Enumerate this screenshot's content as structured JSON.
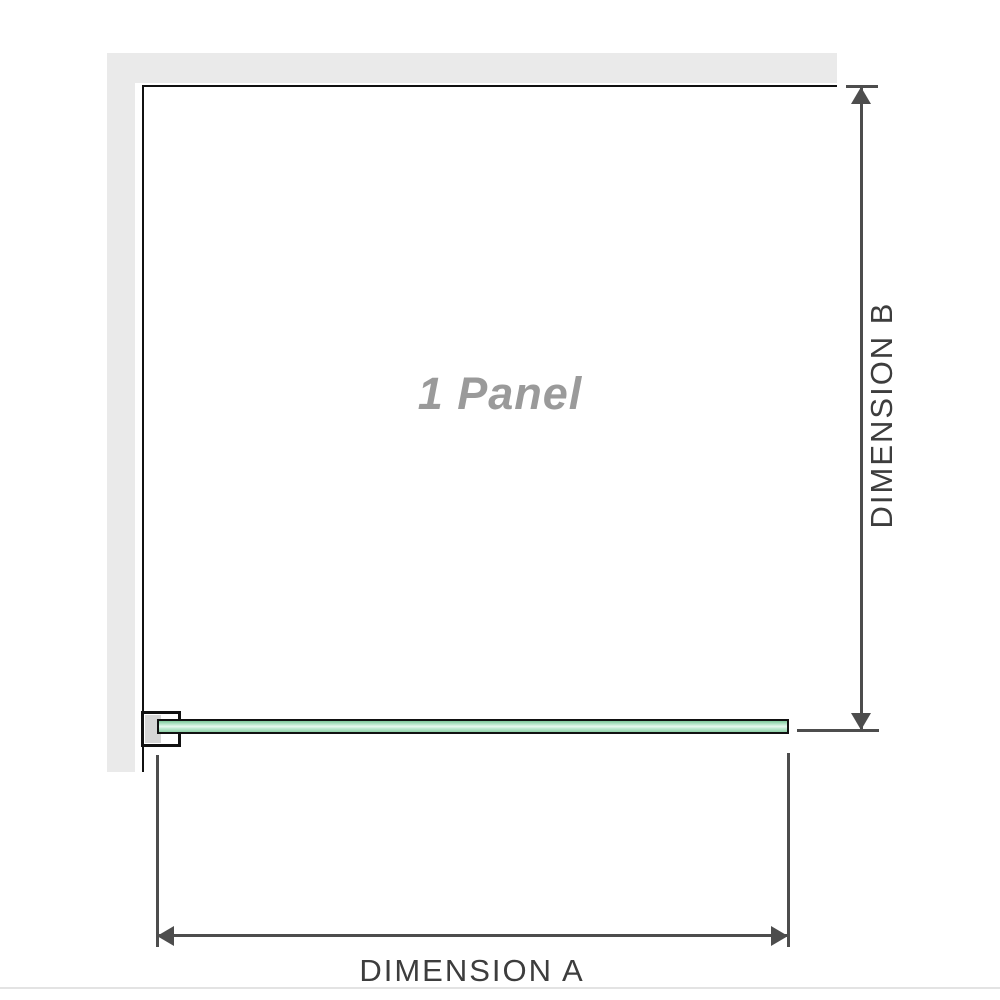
{
  "diagram": {
    "panel_label": "1 Panel",
    "dimension_a": {
      "label": "DIMENSION A"
    },
    "dimension_b": {
      "label": "DIMENSION B"
    }
  },
  "icons": {
    "arrow_up": "triangle-up",
    "arrow_down": "triangle-down",
    "arrow_left": "triangle-left",
    "arrow_right": "triangle-right"
  },
  "colors": {
    "background": "#ffffff",
    "wall_gray": "#eaeaea",
    "frame_black": "#111111",
    "glass_green": "#8fd2a8",
    "glass_highlight": "#e9f9f0",
    "bracket_pad_gray": "#d6d6d6",
    "dimension_line": "#4d4d4d",
    "dimension_text": "#3d3d3d",
    "panel_label_gray": "#9a9a9a",
    "bottom_divider": "#e3e3e3"
  }
}
